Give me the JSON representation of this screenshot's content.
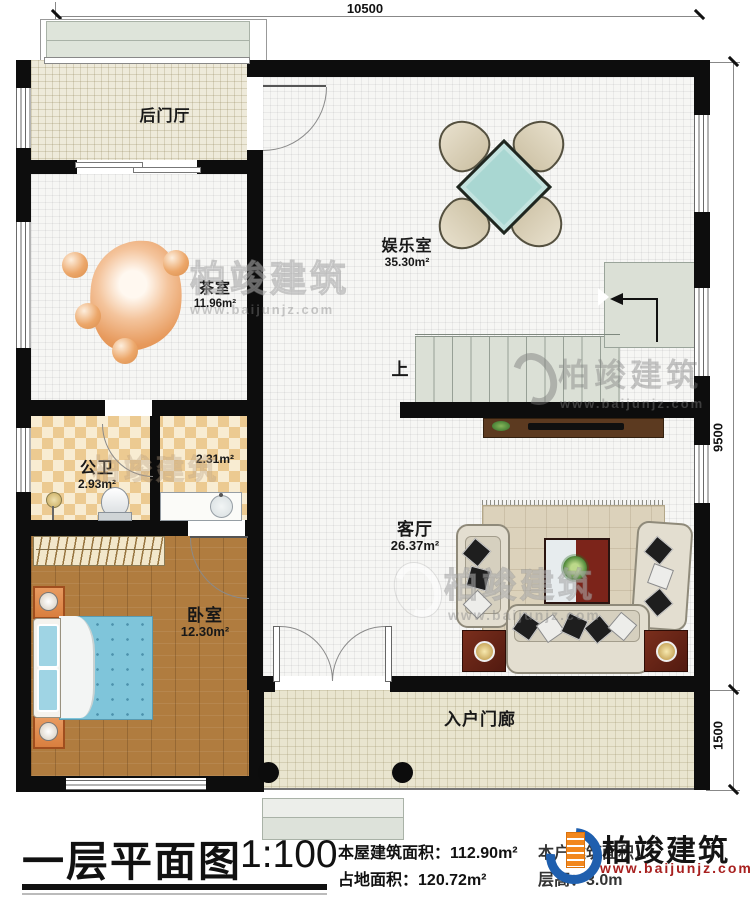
{
  "brand": {
    "name": "柏竣建筑",
    "url": "www.baijunjz.com"
  },
  "dimensions": {
    "top": "10500",
    "right_upper": "9500",
    "right_lower": "1500"
  },
  "rooms": {
    "back_hall": {
      "name": "后门厅"
    },
    "tea_room": {
      "name": "茶室",
      "area": "11.96m²"
    },
    "game_room": {
      "name": "娱乐室",
      "area": "35.30m²"
    },
    "bathroom": {
      "name": "公卫",
      "area": "2.93m²"
    },
    "vanity_area": {
      "area": "2.31m²"
    },
    "bedroom": {
      "name": "卧室",
      "area": "12.30m²"
    },
    "living_room": {
      "name": "客厅",
      "area": "26.37m²"
    },
    "porch": {
      "name": "入户门廊"
    },
    "stairs": {
      "direction_label": "上"
    }
  },
  "title_block": {
    "title": "一层平面图",
    "scale": "1:100",
    "building_area_label": "本屋建筑面积：",
    "building_area_value": "112.90m²",
    "land_area_label": "占地面积：",
    "land_area_value": "120.72m²",
    "unit_area_label": "本户建筑面积：",
    "floor_height_label": "层高：",
    "floor_height_value": "3.0m"
  }
}
